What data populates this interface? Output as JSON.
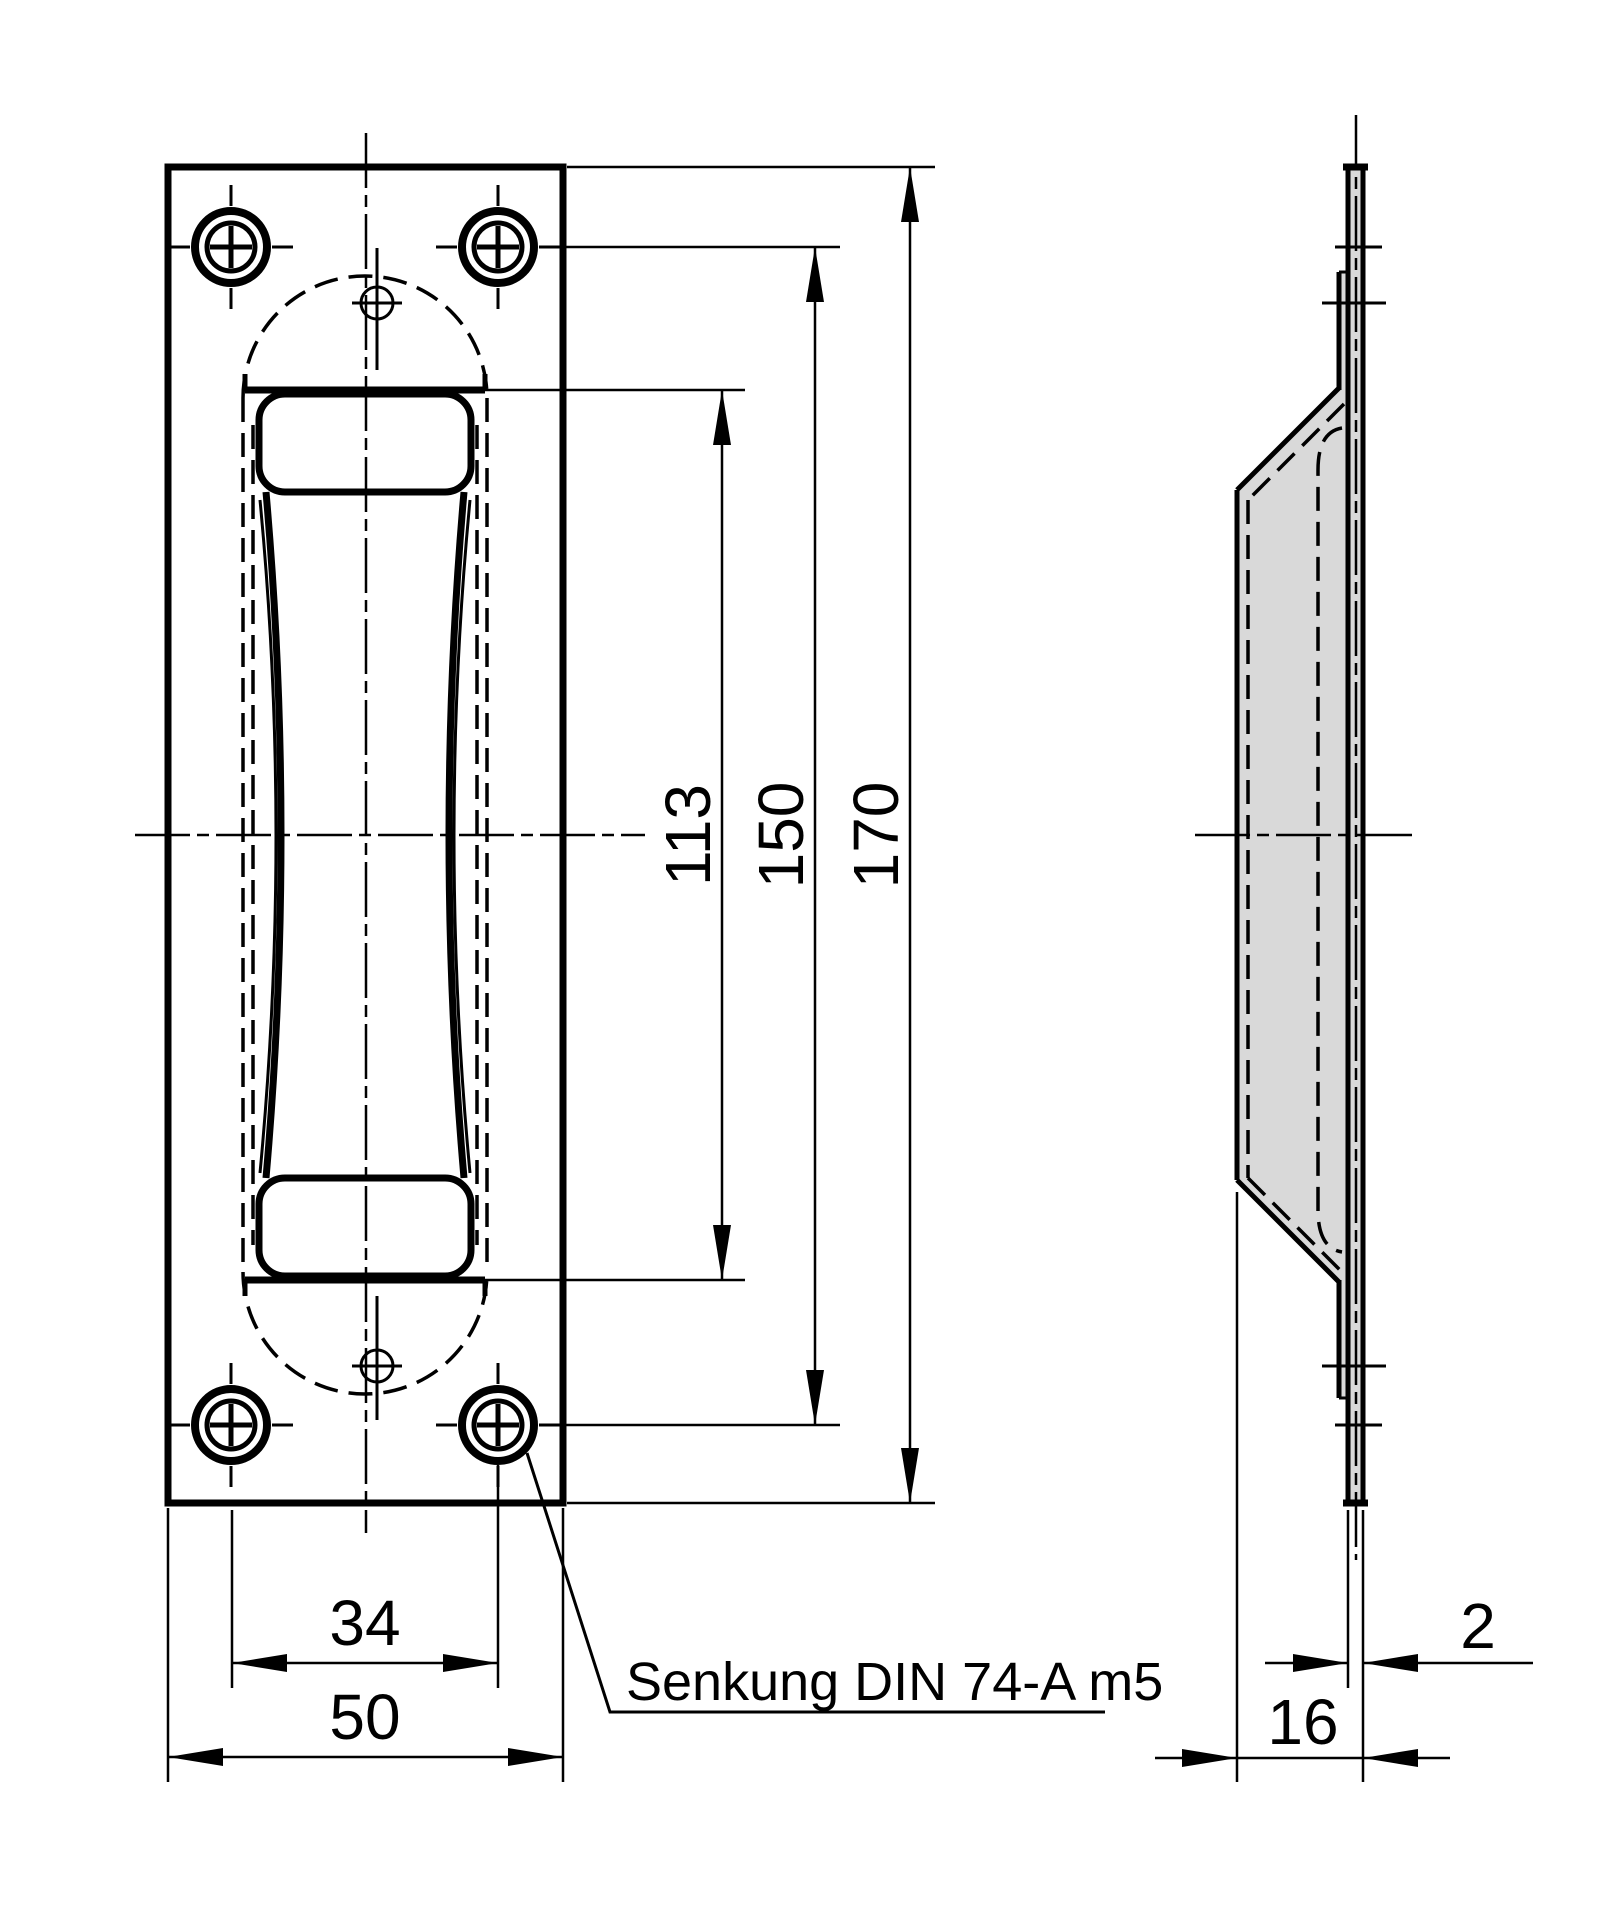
{
  "colors": {
    "line": "#000000",
    "plate_fill": "#d9d9d9",
    "hole_fill": "#ffffff",
    "background": "#ffffff"
  },
  "views": {
    "front": {
      "name": "front-view",
      "dimensions": [
        {
          "id": "recess_opening_length",
          "value": "113",
          "orientation": "vertical"
        },
        {
          "id": "hole_spacing_vertical",
          "value": "150",
          "orientation": "vertical"
        },
        {
          "id": "overall_height",
          "value": "170",
          "orientation": "vertical"
        },
        {
          "id": "hole_spacing_horizontal",
          "value": "34",
          "orientation": "horizontal"
        },
        {
          "id": "overall_width",
          "value": "50",
          "orientation": "horizontal"
        }
      ],
      "note": {
        "text": "Senkung DIN 74-A m5",
        "meaning": "countersink DIN 74-A m5 on screw holes"
      }
    },
    "side": {
      "name": "side-view",
      "dimensions": [
        {
          "id": "plate_thickness",
          "value": "2",
          "orientation": "horizontal"
        },
        {
          "id": "recess_depth",
          "value": "16",
          "orientation": "horizontal"
        }
      ]
    }
  }
}
